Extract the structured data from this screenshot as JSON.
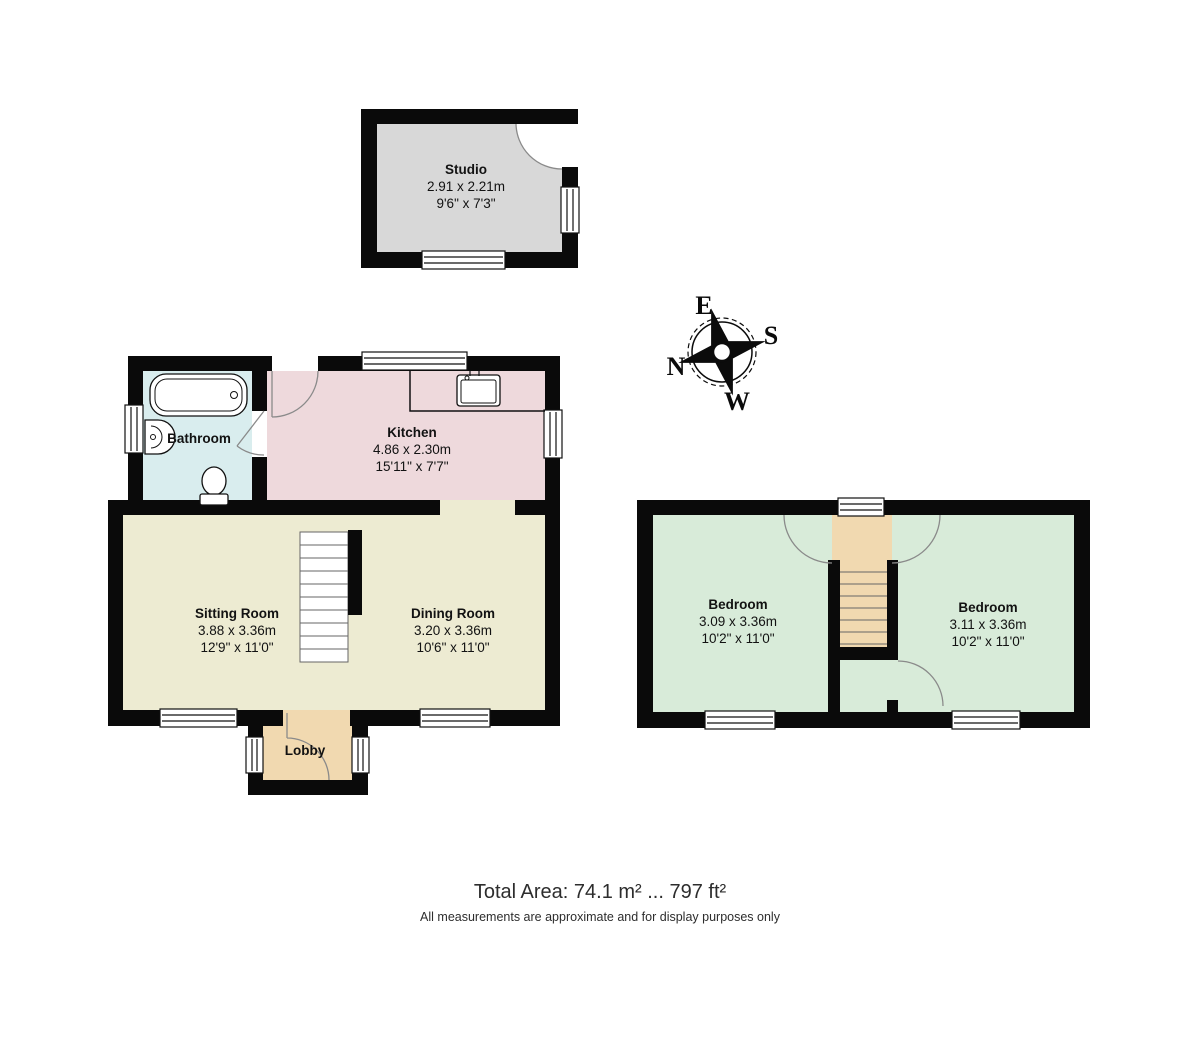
{
  "floorplan": {
    "wall_color": "#0a0a0a",
    "studio": {
      "name": "Studio",
      "metric": "2.91 x 2.21m",
      "imperial": "9'6\" x 7'3\"",
      "fill": "#d8d8d8"
    },
    "ground_floor": {
      "bathroom": {
        "name": "Bathroom",
        "fill": "#d9edee"
      },
      "kitchen": {
        "name": "Kitchen",
        "metric": "4.86 x 2.30m",
        "imperial": "15'11\" x 7'7\"",
        "fill": "#eed9dc"
      },
      "sitting_room": {
        "name": "Sitting Room",
        "metric": "3.88 x 3.36m",
        "imperial": "12'9\" x 11'0\"",
        "fill": "#edebd2"
      },
      "dining_room": {
        "name": "Dining Room",
        "metric": "3.20 x 3.36m",
        "imperial": "10'6\" x 11'0\"",
        "fill": "#edebd2"
      },
      "lobby": {
        "name": "Lobby",
        "fill": "#f1d9b0"
      }
    },
    "first_floor": {
      "bedroom_left": {
        "name": "Bedroom",
        "metric": "3.09 x 3.36m",
        "imperial": "10'2\" x 11'0\"",
        "fill": "#d8ebd9"
      },
      "bedroom_right": {
        "name": "Bedroom",
        "metric": "3.11 x 3.36m",
        "imperial": "10'2\" x 11'0\"",
        "fill": "#d8ebd9"
      },
      "stairwell_fill": "#f1d9b0"
    },
    "compass": {
      "n": "N",
      "e": "E",
      "s": "S",
      "w": "W"
    },
    "footer": {
      "total_area": "Total Area: 74.1 m² ... 797 ft²",
      "disclaimer": "All measurements are approximate and for display purposes only"
    }
  }
}
